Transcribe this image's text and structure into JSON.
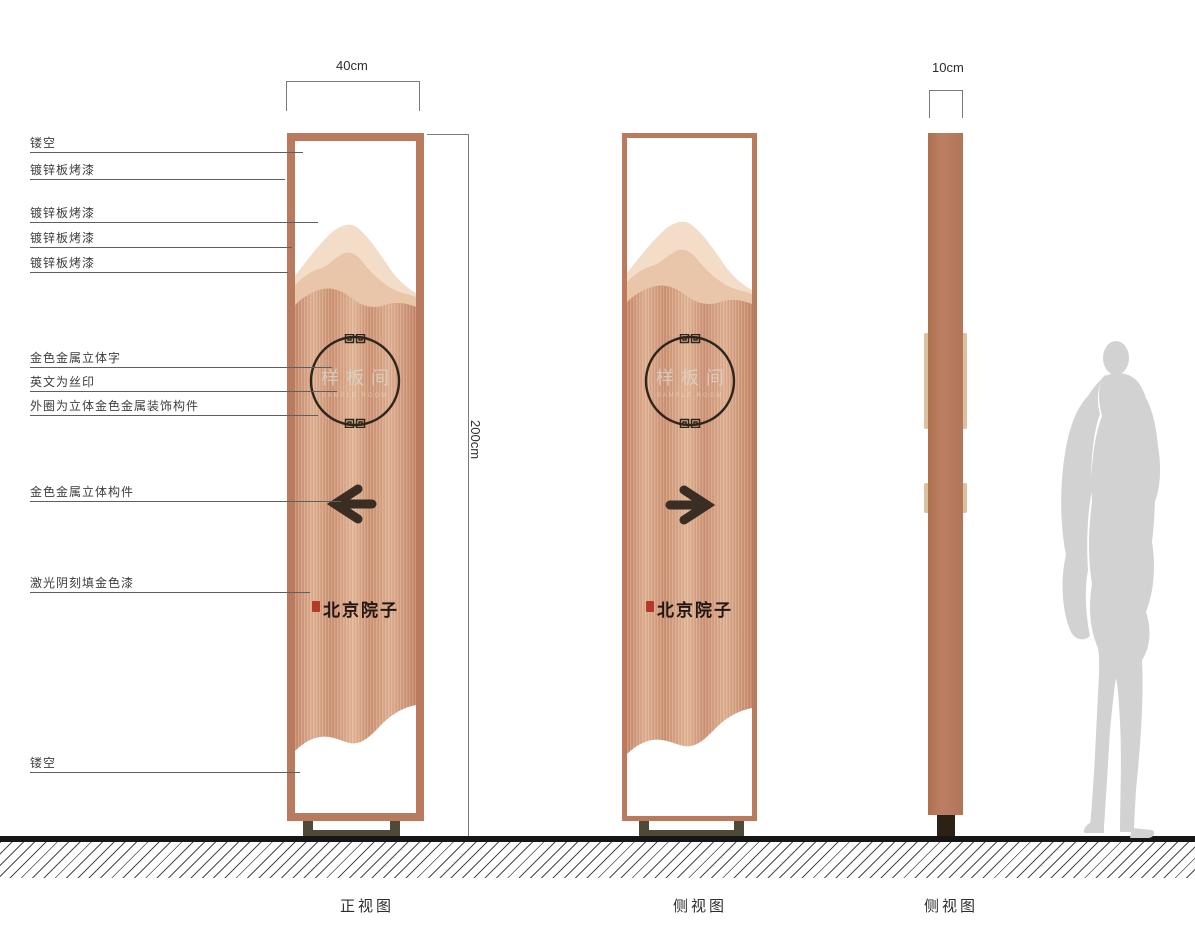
{
  "dimensions": {
    "width_label": "40cm",
    "height_label": "200cm",
    "depth_label": "10cm"
  },
  "callouts": [
    {
      "label": "镂空"
    },
    {
      "label": "镀锌板烤漆"
    },
    {
      "label": "镀锌板烤漆"
    },
    {
      "label": "镀锌板烤漆"
    },
    {
      "label": "镀锌板烤漆"
    },
    {
      "label": "金色金属立体字"
    },
    {
      "label": "英文为丝印"
    },
    {
      "label": "外圈为立体金色金属装饰构件"
    },
    {
      "label": "金色金属立体构件"
    },
    {
      "label": "激光阴刻填金色漆"
    },
    {
      "label": "镂空"
    }
  ],
  "sign": {
    "room_name": "样板间",
    "room_name_en": "SAMPLE ROOM",
    "brand_name": "北京院子"
  },
  "views": [
    {
      "caption": "正视图"
    },
    {
      "caption": "侧视图"
    },
    {
      "caption": "侧视图"
    }
  ],
  "colors": {
    "frame": "#b97a5e",
    "copper_light": "#e3b797",
    "copper_dark": "#c78a6c",
    "mountain_back": "#f3ddc8",
    "mountain_mid": "#e9c5a9",
    "ink": "#2e261d",
    "seal_red": "#b23a28",
    "base_olive": "#4e4a37",
    "ground": "#161616",
    "silhouette": "#d2d2d2"
  }
}
